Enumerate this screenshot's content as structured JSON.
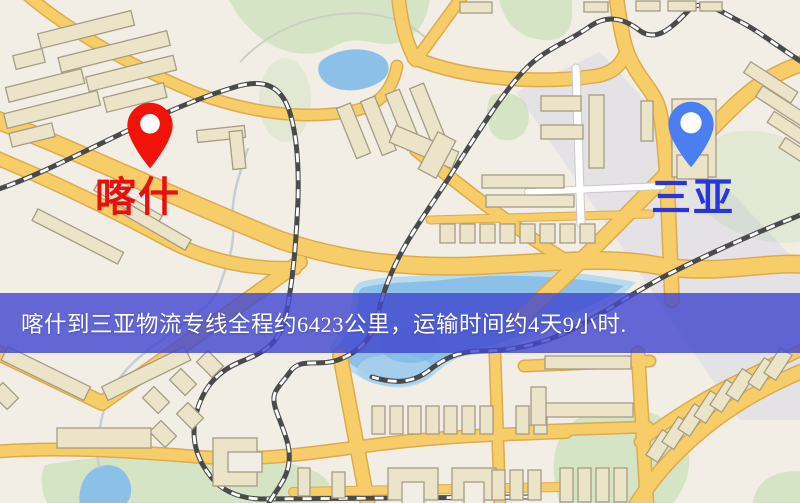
{
  "map": {
    "origin_label": "喀什",
    "destination_label": "三亚"
  },
  "route": {
    "origin": "喀什",
    "destination": "三亚",
    "distance_text": "约6423公里",
    "duration_text": "约4天9小时"
  },
  "banner": {
    "text": "喀什到三亚物流专线全程约6423公里，运输时间约4天9小时."
  },
  "colors": {
    "banner_bg": "#4348cf",
    "banner_bg_rgba": "rgba(67,72,207,0.82)",
    "banner_text": "#ffffff",
    "origin_pin": "#f11208",
    "destination_pin": "#4b7ef0",
    "origin_label": "#e90f0f",
    "destination_label": "#2834dc",
    "road_fill": "#f6cd68",
    "road_casing": "#dcab50",
    "water": "#8cc0e8",
    "green": "#d5e4c4",
    "building": "#ece4c8",
    "building_stroke": "#a59c84",
    "rail": "#4a4a4a",
    "map_bg": "#f2eee5"
  }
}
